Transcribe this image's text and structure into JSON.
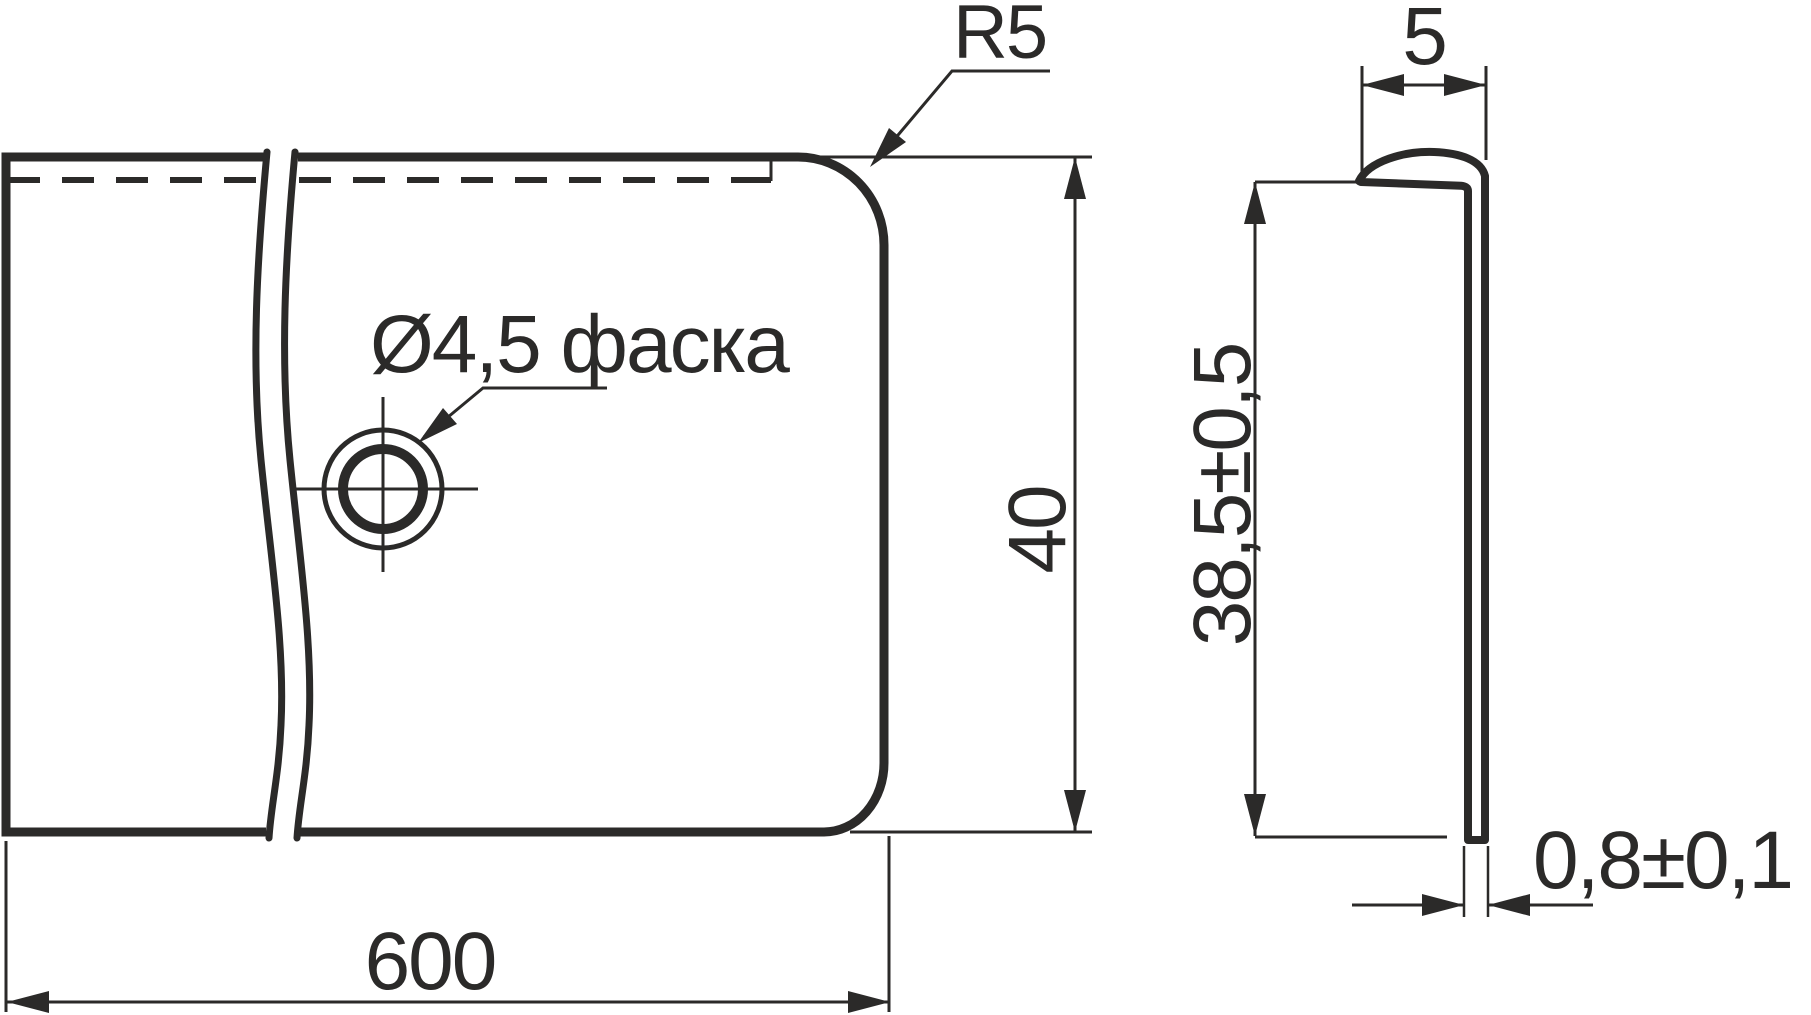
{
  "drawing": {
    "type": "technical-dimension-drawing",
    "colors": {
      "ink": "#2b2a29",
      "paper": "#ffffff"
    },
    "labels": {
      "corner_radius": "R5",
      "flange_width": "5",
      "hole_note": "Ø4,5 фаска",
      "front_height": "40",
      "side_height": "38,5±0,5",
      "length": "600",
      "thickness": "0,8±0,1"
    }
  }
}
